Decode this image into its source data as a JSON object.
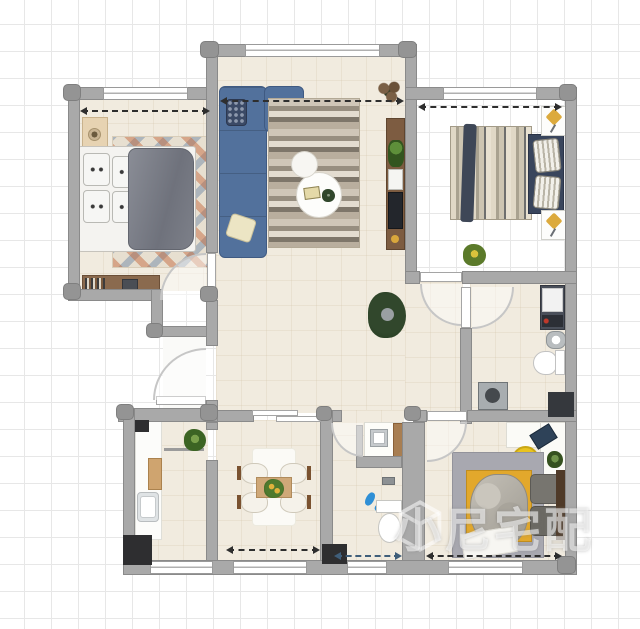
{
  "watermark": {
    "icon": "cube-logo-icon",
    "text": "小尼宅配"
  },
  "scene": {
    "type": "apartment-floor-plan-render",
    "background": "grid-paper",
    "rooms": [
      {
        "name": "bedroom-top-left",
        "furniture": [
          "double-bed-grey-duvet",
          "patterned-rug",
          "nightstand-with-lamp",
          "desk-with-books-and-laptop"
        ]
      },
      {
        "name": "living-room",
        "furniture": [
          "blue-sectional-sofa",
          "striped-area-rug",
          "round-coffee-tables",
          "tv-cabinet",
          "potted-plants"
        ]
      },
      {
        "name": "bedroom-top-right",
        "furniture": [
          "striped-double-bed",
          "dark-headboard-with-pillows",
          "nightstands-with-yellow-cushions",
          "potted-plant"
        ]
      },
      {
        "name": "bathroom-right",
        "furniture": [
          "washing-machine",
          "washbasin",
          "toilet",
          "mop-pool",
          "shower-block"
        ]
      },
      {
        "name": "hallway",
        "furniture": [
          "potted-plant"
        ]
      },
      {
        "name": "entry-porch",
        "furniture": [
          "entry-door"
        ]
      },
      {
        "name": "kitchen",
        "furniture": [
          "counter-with-sink",
          "cutting-board",
          "potted-plant"
        ]
      },
      {
        "name": "dining-room",
        "furniture": [
          "dining-table",
          "four-white-chairs",
          "centerpiece-plant",
          "white-rug"
        ]
      },
      {
        "name": "small-bathroom",
        "furniture": [
          "vanity-washbasin",
          "toilet",
          "blue-slippers"
        ]
      },
      {
        "name": "bedroom-bottom-right",
        "furniture": [
          "bed-yellow-and-grey-bedding",
          "grey-rug",
          "corner-desk-with-laptop",
          "yellow-chair",
          "small-plant"
        ]
      }
    ]
  },
  "palette": {
    "grid_line": "#e7e7e7",
    "wall": "#a9a9a9",
    "floor_tile": "#f1ebdf",
    "black_column": "#2e2e30",
    "sofa_blue": "#52719c",
    "bed_yellow": "#e2a82c",
    "chair_yellow": "#e9c31e",
    "slipper_blue": "#2f8fd6",
    "wood": "#8a6a4e",
    "plant_green": "#31472c",
    "watermark": "#ffffff"
  }
}
